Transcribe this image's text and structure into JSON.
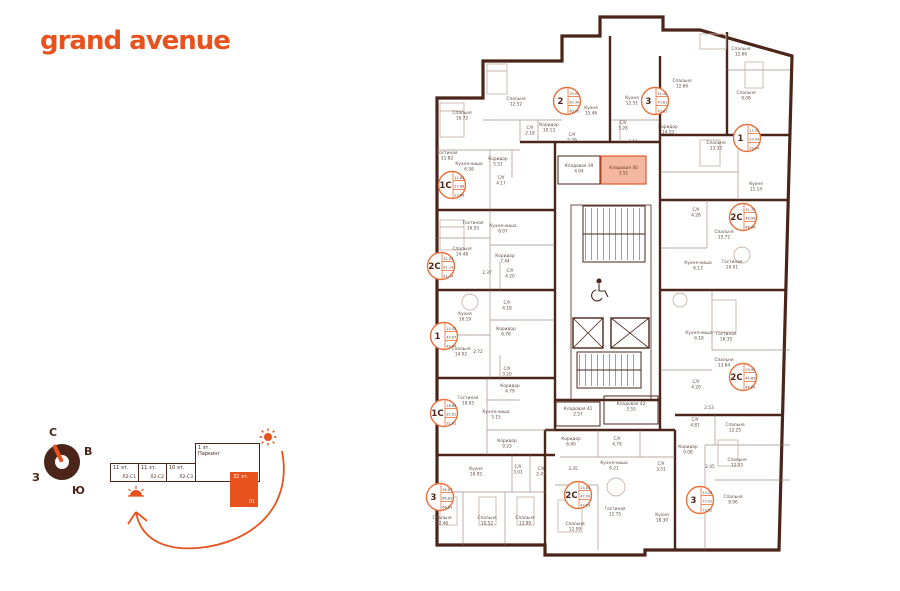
{
  "brand": {
    "name": "grand avenue"
  },
  "colors": {
    "accent": "#E8521D",
    "wall": "#4B2519",
    "selection_fill": "#F5B79F",
    "selection_stroke": "#E05A2B",
    "badge_stroke": "#E8703A"
  },
  "compass": {
    "north": "С",
    "east": "В",
    "south": "Ю",
    "west": "З"
  },
  "scheme": {
    "blocks": [
      {
        "floors": "11 эт.",
        "label": "Л2-С1",
        "active": false
      },
      {
        "floors": "11 эт.",
        "label": "Л2-С2",
        "active": false
      },
      {
        "floors": "10 эт.",
        "label": "Л2-С3",
        "active": false
      },
      {
        "floors": "1 эт.",
        "label": "Паркинг",
        "active": false
      },
      {
        "floors": "32 эт.",
        "label": "Л1",
        "active": true
      }
    ]
  },
  "plan": {
    "selected_unit": {
      "label": "Кладовая 40",
      "area": "3.51",
      "x": 601,
      "y": 156,
      "w": 45,
      "h": 28
    },
    "rooms": [
      {
        "label": "Спальня",
        "area": "16.72",
        "x": 462,
        "y": 114
      },
      {
        "label": "Спальня",
        "area": "12.52",
        "x": 516,
        "y": 100
      },
      {
        "label": "С/У",
        "area": "2.18",
        "x": 530,
        "y": 129
      },
      {
        "label": "Коридор",
        "area": "10.13",
        "x": 549,
        "y": 126
      },
      {
        "label": "Гостиная",
        "area": "11.82",
        "x": 447,
        "y": 154
      },
      {
        "label": "Кухня-ниша",
        "area": "6.58",
        "x": 469,
        "y": 165
      },
      {
        "label": "Коридор",
        "area": "5.51",
        "x": 498,
        "y": 160
      },
      {
        "label": "С/У",
        "area": "4.17",
        "x": 501,
        "y": 179
      },
      {
        "label": "С/У",
        "area": "5.29",
        "x": 572,
        "y": 136
      },
      {
        "label": "Гостиная",
        "area": "16.55",
        "x": 473,
        "y": 224
      },
      {
        "label": "Кухня-ниша",
        "area": "6.07",
        "x": 503,
        "y": 227
      },
      {
        "label": "Спальня",
        "area": "14.48",
        "x": 462,
        "y": 250
      },
      {
        "label": "Коридор",
        "area": "7.44",
        "x": 505,
        "y": 257
      },
      {
        "label": "",
        "area": "2.37",
        "x": 487,
        "y": 274
      },
      {
        "label": "С/У",
        "area": "4.20",
        "x": 510,
        "y": 272
      },
      {
        "label": "С/У",
        "area": "4.18",
        "x": 507,
        "y": 304
      },
      {
        "label": "Кухня",
        "area": "16.19",
        "x": 465,
        "y": 315
      },
      {
        "label": "Коридор",
        "area": "6.76",
        "x": 506,
        "y": 330
      },
      {
        "label": "Спальня",
        "area": "14.02",
        "x": 461,
        "y": 350
      },
      {
        "label": "",
        "area": "2.72",
        "x": 478,
        "y": 353
      },
      {
        "label": "С/У",
        "area": "3.20",
        "x": 507,
        "y": 370
      },
      {
        "label": "Коридор",
        "area": "4.79",
        "x": 510,
        "y": 387
      },
      {
        "label": "Гостиная",
        "area": "18.65",
        "x": 468,
        "y": 399
      },
      {
        "label": "Кухня-ниша",
        "area": "5.15",
        "x": 496,
        "y": 413
      },
      {
        "label": "Коридор",
        "area": "9.23",
        "x": 507,
        "y": 442
      },
      {
        "label": "Кухня",
        "area": "16.95",
        "x": 476,
        "y": 470
      },
      {
        "label": "С/У",
        "area": "3.01",
        "x": 518,
        "y": 468
      },
      {
        "label": "С/У",
        "area": "2.47",
        "x": 541,
        "y": 470
      },
      {
        "label": "Спальня",
        "area": "12.46",
        "x": 442,
        "y": 519
      },
      {
        "label": "Спальня",
        "area": "10.52",
        "x": 487,
        "y": 519
      },
      {
        "label": "Спальня",
        "area": "13.99",
        "x": 525,
        "y": 519
      },
      {
        "label": "Кухня",
        "area": "15.46",
        "x": 591,
        "y": 109
      },
      {
        "label": "Кухня",
        "area": "12.51",
        "x": 632,
        "y": 99
      },
      {
        "label": "С/У",
        "area": "3.28",
        "x": 623,
        "y": 124
      },
      {
        "label": "Коридор",
        "area": "14.10",
        "x": 668,
        "y": 128
      },
      {
        "label": "",
        "area": "3.10",
        "x": 633,
        "y": 143
      },
      {
        "label": "Кладовая 39",
        "area": "4.04",
        "x": 579,
        "y": 167
      },
      {
        "label": "Кладовая 41",
        "area": "2.57",
        "x": 578,
        "y": 410
      },
      {
        "label": "Кладовая 42",
        "area": "3.55",
        "x": 631,
        "y": 405
      },
      {
        "label": "Коридор",
        "area": "6.40",
        "x": 571,
        "y": 440
      },
      {
        "label": "С/У",
        "area": "4.79",
        "x": 617,
        "y": 440
      },
      {
        "label": "Кухня-ниша",
        "area": "6.21",
        "x": 614,
        "y": 464
      },
      {
        "label": "С/У",
        "area": "3.51",
        "x": 661,
        "y": 465
      },
      {
        "label": "",
        "area": "3.35",
        "x": 573,
        "y": 470
      },
      {
        "label": "Гостиная",
        "area": "12.75",
        "x": 615,
        "y": 510
      },
      {
        "label": "Спальня",
        "area": "12.09",
        "x": 575,
        "y": 525
      },
      {
        "label": "Кухня",
        "area": "18.30",
        "x": 662,
        "y": 516
      },
      {
        "label": "Спальня",
        "area": "12.66",
        "x": 682,
        "y": 82
      },
      {
        "label": "Спальня",
        "area": "12.66",
        "x": 741,
        "y": 50
      },
      {
        "label": "Спальня",
        "area": "9.08",
        "x": 746,
        "y": 94
      },
      {
        "label": "Спальня",
        "area": "13.35",
        "x": 716,
        "y": 144
      },
      {
        "label": "Кухня",
        "area": "11.14",
        "x": 756,
        "y": 185
      },
      {
        "label": "С/У",
        "area": "4.28",
        "x": 696,
        "y": 211
      },
      {
        "label": "Спальня",
        "area": "15.72",
        "x": 724,
        "y": 233
      },
      {
        "label": "Кухня-ниша",
        "area": "6.13",
        "x": 698,
        "y": 264
      },
      {
        "label": "Гостиная",
        "area": "16.01",
        "x": 732,
        "y": 263
      },
      {
        "label": "Кухня-ниша",
        "area": "6.18",
        "x": 699,
        "y": 334
      },
      {
        "label": "Гостиная",
        "area": "16.35",
        "x": 726,
        "y": 335
      },
      {
        "label": "Спальня",
        "area": "13.64",
        "x": 724,
        "y": 361
      },
      {
        "label": "С/У",
        "area": "4.20",
        "x": 696,
        "y": 383
      },
      {
        "label": "",
        "area": "2.53",
        "x": 709,
        "y": 409
      },
      {
        "label": "Спальня",
        "area": "12.25",
        "x": 735,
        "y": 426
      },
      {
        "label": "С/У",
        "area": "4.81",
        "x": 695,
        "y": 421
      },
      {
        "label": "Коридор",
        "area": "9.08",
        "x": 688,
        "y": 448
      },
      {
        "label": "Спальня",
        "area": "12.33",
        "x": 737,
        "y": 461
      },
      {
        "label": "",
        "area": "2.45",
        "x": 710,
        "y": 468
      },
      {
        "label": "Спальня",
        "area": "8.96",
        "x": 733,
        "y": 498
      }
    ],
    "apartments": [
      {
        "type": "1С",
        "values": [
          "11.82",
          "27.88",
          "27.88"
        ],
        "cx": 452,
        "cy": 185
      },
      {
        "type": "2С",
        "values": [
          "31.03",
          "61.14",
          "61.14"
        ],
        "cx": 441,
        "cy": 266
      },
      {
        "type": "1",
        "values": [
          "14.02",
          "43.87",
          "43.87"
        ],
        "cx": 444,
        "cy": 336
      },
      {
        "type": "1С",
        "values": [
          "18.65",
          "31.81",
          "31.81"
        ],
        "cx": 444,
        "cy": 413
      },
      {
        "type": "3",
        "values": [
          "36.87",
          "66.83",
          "66.83"
        ],
        "cx": 440,
        "cy": 497
      },
      {
        "type": "2",
        "values": [
          "29.05",
          "60.30",
          "60.30"
        ],
        "cx": 567,
        "cy": 101
      },
      {
        "type": "3",
        "values": [
          "34.42",
          "70.81",
          "70.81"
        ],
        "cx": 655,
        "cy": 101
      },
      {
        "type": "1",
        "values": [
          "13.35",
          "33.04",
          "33.04"
        ],
        "cx": 747,
        "cy": 138
      },
      {
        "type": "2С",
        "values": [
          "31.73",
          "48.06",
          "48.06"
        ],
        "cx": 743,
        "cy": 217
      },
      {
        "type": "2С",
        "values": [
          "29.99",
          "44.89",
          "44.89"
        ],
        "cx": 743,
        "cy": 377
      },
      {
        "type": "2С",
        "values": [
          "24.84",
          "47.09",
          "47.09"
        ],
        "cx": 578,
        "cy": 495
      },
      {
        "type": "3",
        "values": [
          "33.54",
          "73.02",
          "73.02"
        ],
        "cx": 700,
        "cy": 500
      }
    ]
  }
}
